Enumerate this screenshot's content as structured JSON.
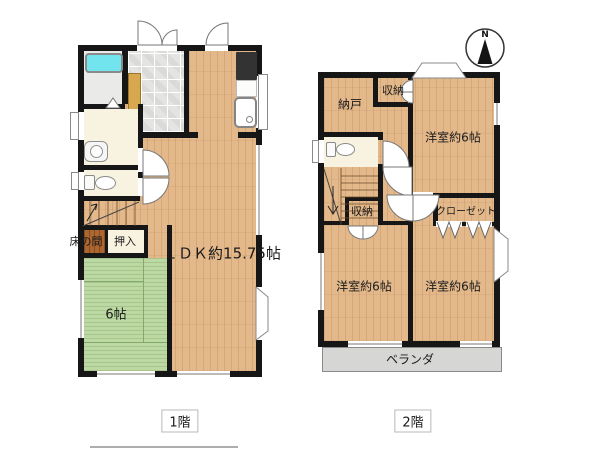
{
  "floor1": {
    "label": "1階",
    "rooms": {
      "ldk": "ＬＤＫ約15.75帖",
      "tatami": "6帖",
      "tokonoma": "床の間",
      "oshiire": "押入"
    }
  },
  "floor2": {
    "label": "2階",
    "rooms": {
      "nando": "納戸",
      "storage_top": "収納",
      "storage_mid": "収納",
      "closet": "クローゼット",
      "bedroom_ne": "洋室約6帖",
      "bedroom_sw": "洋室約6帖",
      "bedroom_se": "洋室約6帖",
      "veranda": "ベランダ"
    },
    "compass_n": "N"
  },
  "colors": {
    "wood": "#e3b98c",
    "tatami_green": "#bcd9a4",
    "wall_black": "#161616",
    "bathtub_cyan": "#72e4ee",
    "cream": "#f8f3e0",
    "tokonoma_brown": "#ad6630",
    "veranda_gray": "#d6d6d4",
    "cabinet_tan": "#d8a851"
  }
}
